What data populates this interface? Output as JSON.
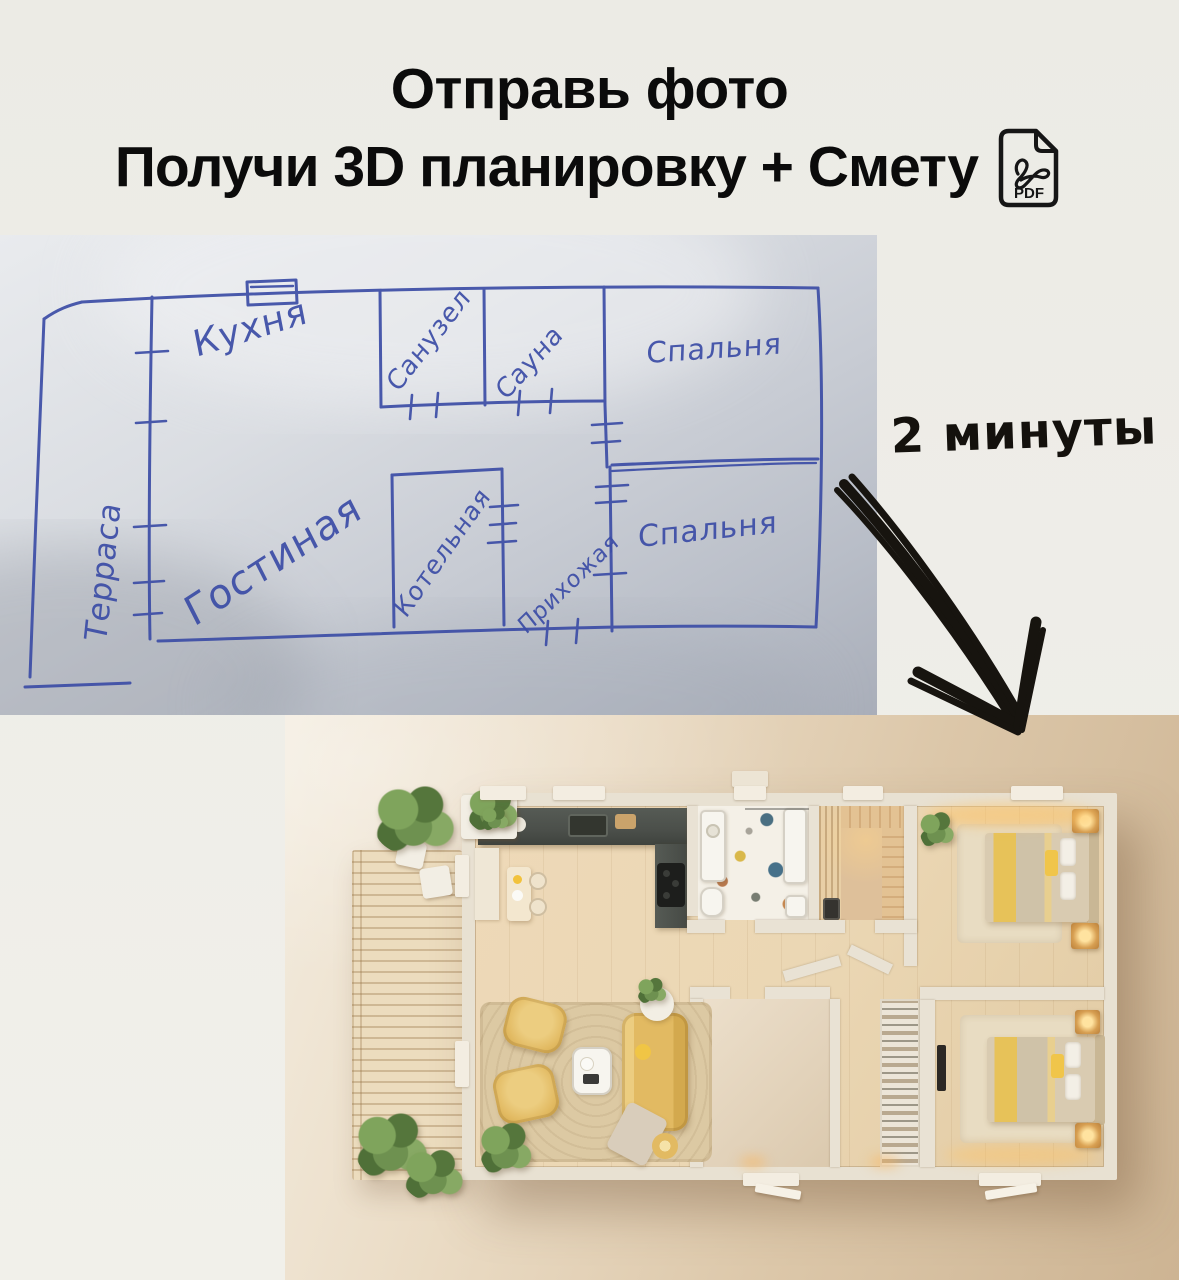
{
  "page": {
    "background": "#edece6"
  },
  "header": {
    "line1": "Отправь фото",
    "line2": "Получи 3D планировку + Смету",
    "pdf_badge": "PDF"
  },
  "sketch": {
    "pen_color": "#3c4da6",
    "labels": {
      "terrace": "Терраса",
      "kitchen": "Кухня",
      "bathroom": "Санузел",
      "sauna": "Сауна",
      "bedroom_top": "Спальня",
      "living_room": "Гостиная",
      "boiler_room": "Котельная",
      "hallway": "Прихожая",
      "bedroom_bottom": "Спальня"
    }
  },
  "annotation": {
    "duration": "2 минуты",
    "arrow_color": "#17140f"
  },
  "render_palette": {
    "background_light": "#f3ecdf",
    "background_dark": "#cdb493",
    "wall": "#e8e1d2",
    "wood_floor": "#ebd7b4",
    "deck": "#ecdcbe",
    "counter_dark": "#4b4f4a",
    "accent_yellow": "#e2ba62",
    "plant_green": "#6e9150",
    "terrazzo_base": "#f4f0e7"
  }
}
